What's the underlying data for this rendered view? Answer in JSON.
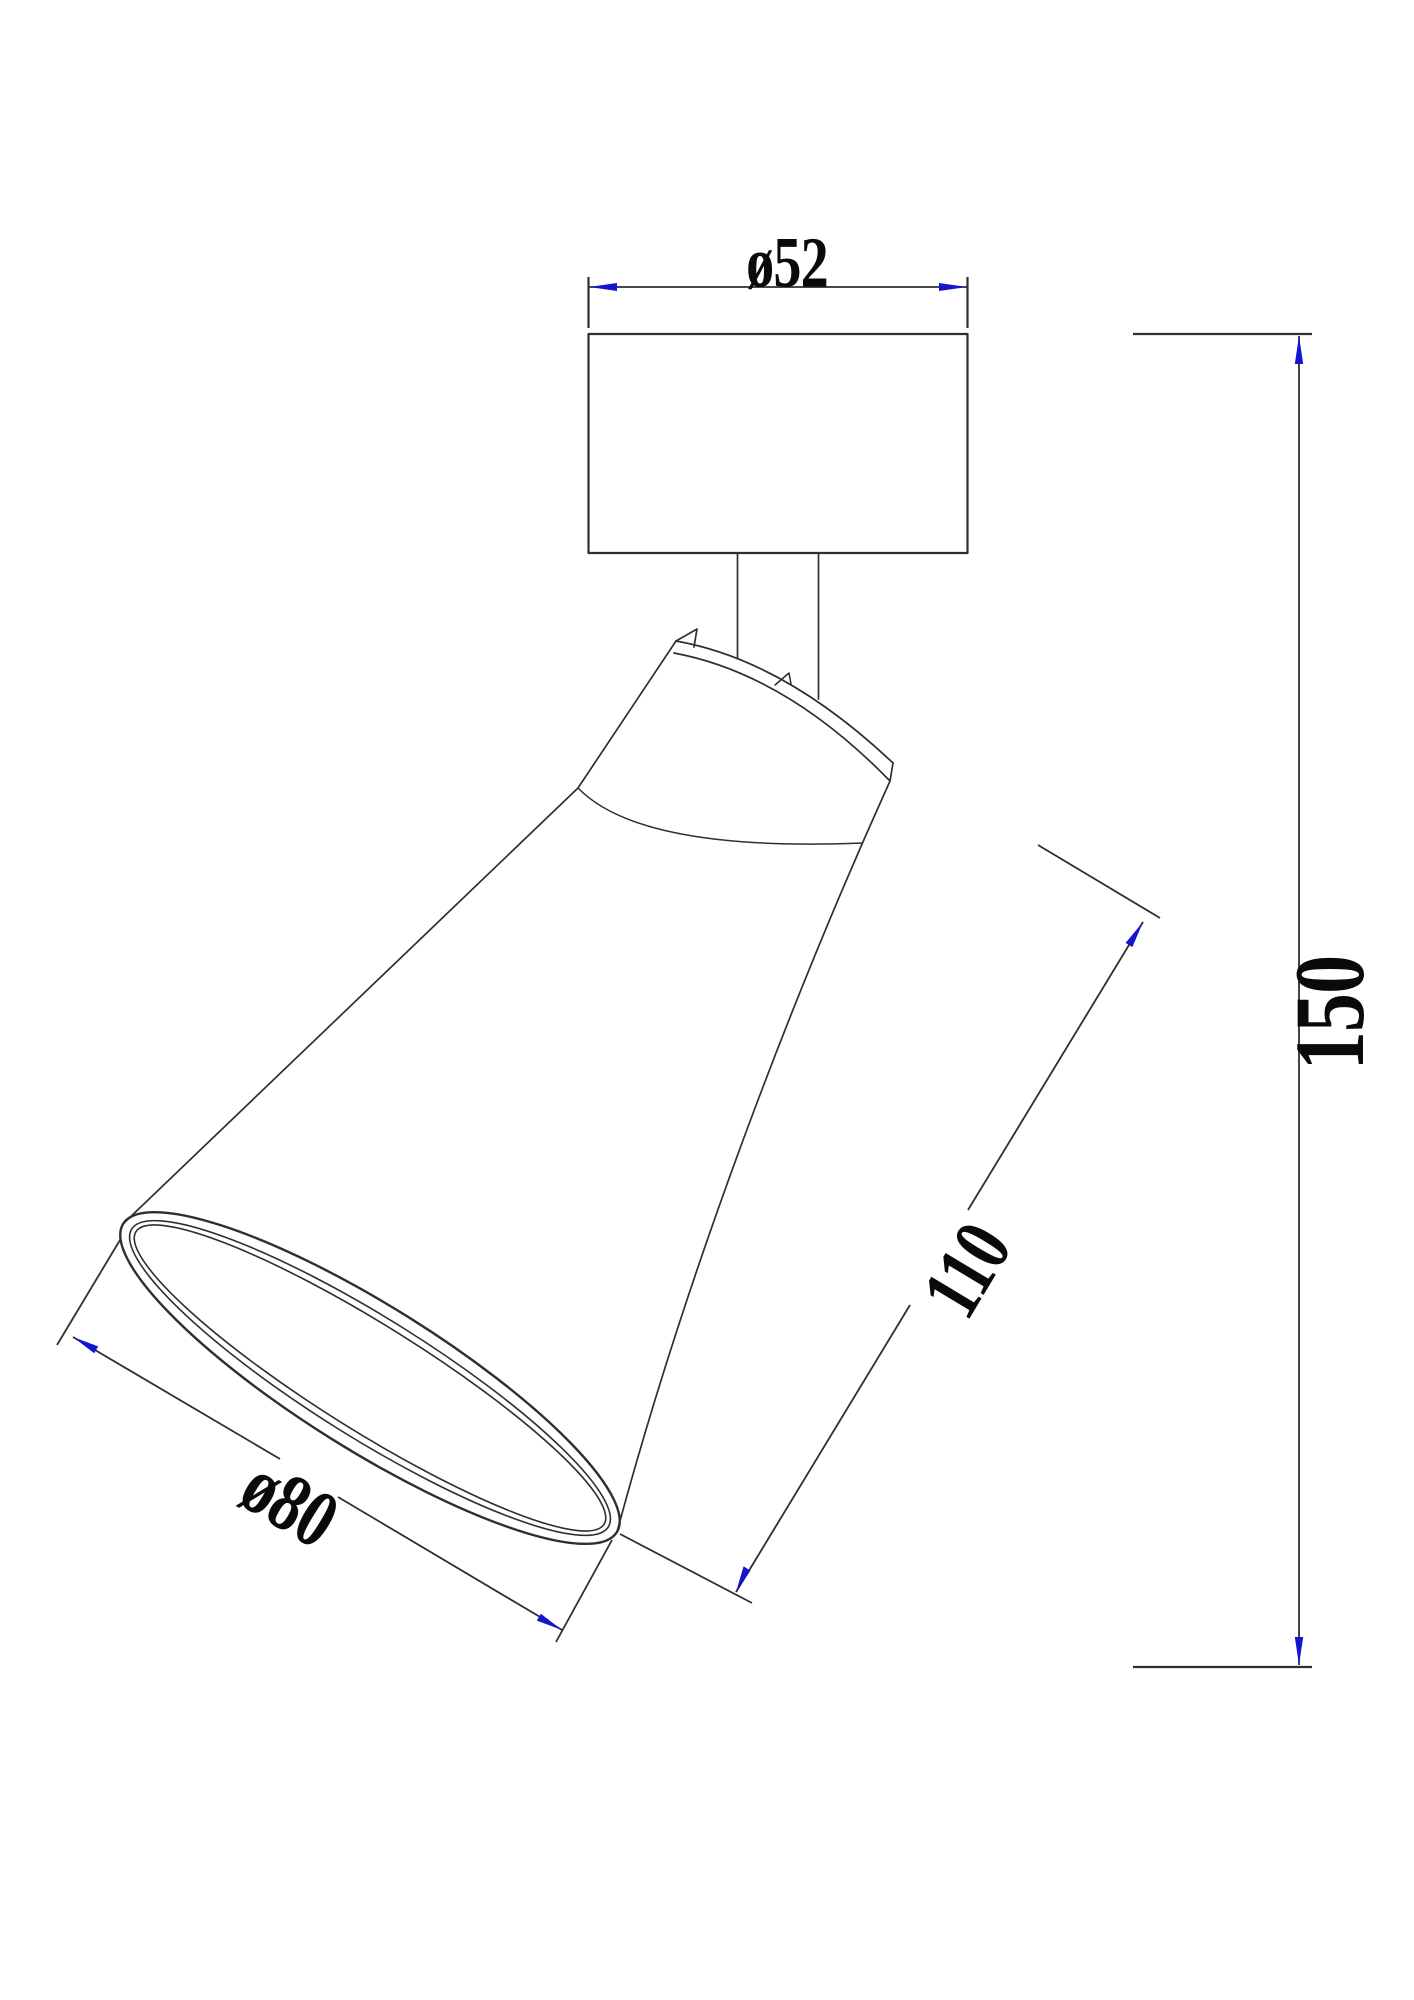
{
  "drawing": {
    "type": "technical-dimension-drawing",
    "subject": "ceiling spot light fixture side view",
    "background_color": "#ffffff",
    "line_color": "#2f2f2f",
    "arrow_color": "#1515cf",
    "text_color": "#0a0a0a",
    "dimensions": {
      "canopy_diameter": {
        "label": "ø52",
        "value": 52,
        "unit": "mm",
        "kind": "diameter",
        "measures": "mounting canopy width"
      },
      "overall_height": {
        "label": "150",
        "value": 150,
        "unit": "mm",
        "kind": "linear",
        "measures": "overall fixture height"
      },
      "head_length": {
        "label": "110",
        "value": 110,
        "unit": "mm",
        "kind": "linear",
        "measures": "lamp head length along axis"
      },
      "opening_diameter": {
        "label": "ø80",
        "value": 80,
        "unit": "mm",
        "kind": "diameter",
        "measures": "shade opening width"
      }
    }
  }
}
